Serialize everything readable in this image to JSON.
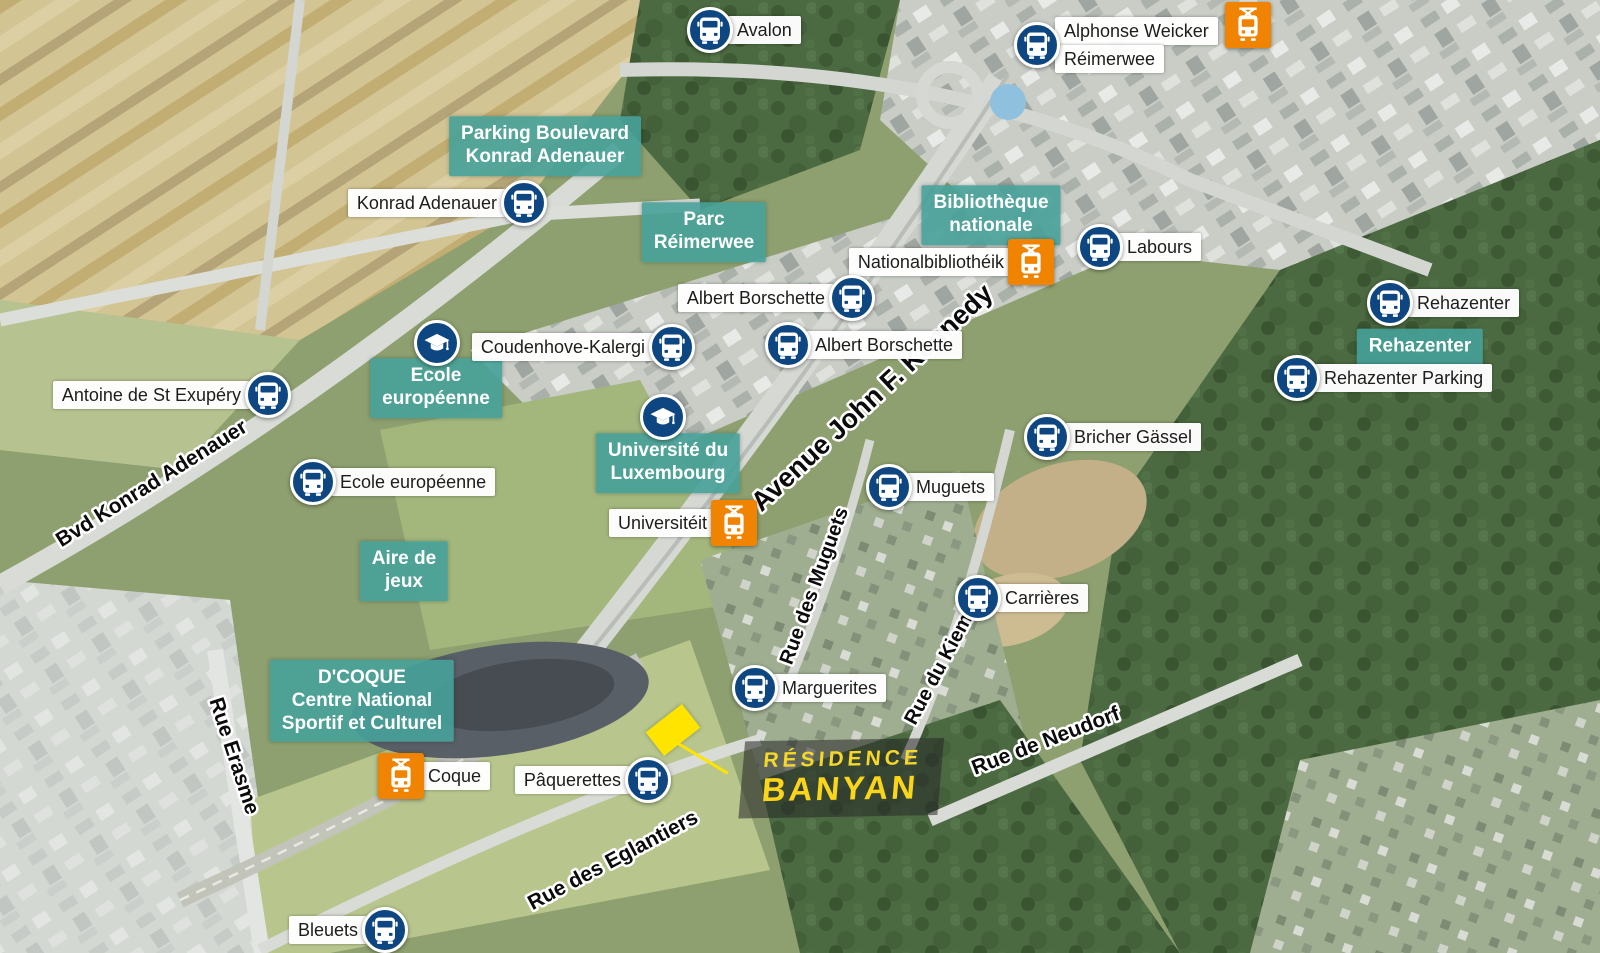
{
  "map": {
    "residence": {
      "line1": "RÉSIDENCE",
      "line2": "BANYAN"
    },
    "bus_stops": [
      {
        "lines": [
          "Avalon"
        ],
        "x": 710,
        "y": 30,
        "label_side": "right"
      },
      {
        "lines": [
          "Alphonse Weicker",
          "Réimerwee"
        ],
        "x": 1037,
        "y": 45,
        "label_side": "right"
      },
      {
        "lines": [
          "Konrad Adenauer"
        ],
        "x": 524,
        "y": 203,
        "label_side": "left"
      },
      {
        "lines": [
          "Labours"
        ],
        "x": 1100,
        "y": 247,
        "label_side": "right"
      },
      {
        "lines": [
          "Albert Borschette"
        ],
        "x": 852,
        "y": 298,
        "label_side": "left"
      },
      {
        "lines": [
          "Albert Borschette"
        ],
        "x": 788,
        "y": 345,
        "label_side": "right"
      },
      {
        "lines": [
          "Coudenhove-Kalergi"
        ],
        "x": 672,
        "y": 347,
        "label_side": "left"
      },
      {
        "lines": [
          "Rehazenter"
        ],
        "x": 1390,
        "y": 303,
        "label_side": "right"
      },
      {
        "lines": [
          "Rehazenter Parking"
        ],
        "x": 1297,
        "y": 378,
        "label_side": "right"
      },
      {
        "lines": [
          "Antoine de St Exupéry"
        ],
        "x": 268,
        "y": 395,
        "label_side": "left"
      },
      {
        "lines": [
          "Ecole européenne"
        ],
        "x": 313,
        "y": 482,
        "label_side": "right"
      },
      {
        "lines": [
          "Bricher Gässel"
        ],
        "x": 1047,
        "y": 437,
        "label_side": "right"
      },
      {
        "lines": [
          "Muguets"
        ],
        "x": 889,
        "y": 487,
        "label_side": "right"
      },
      {
        "lines": [
          "Carrières"
        ],
        "x": 978,
        "y": 598,
        "label_side": "right"
      },
      {
        "lines": [
          "Marguerites"
        ],
        "x": 755,
        "y": 688,
        "label_side": "right"
      },
      {
        "lines": [
          "Pâquerettes"
        ],
        "x": 648,
        "y": 780,
        "label_side": "left"
      },
      {
        "lines": [
          "Bleuets"
        ],
        "x": 385,
        "y": 930,
        "label_side": "left"
      }
    ],
    "tram_stops": [
      {
        "lines": [],
        "x": 1248,
        "y": 25,
        "label_side": "none"
      },
      {
        "lines": [
          "Nationalbibliothéik"
        ],
        "x": 1031,
        "y": 262,
        "label_side": "left"
      },
      {
        "lines": [
          "Universitéit"
        ],
        "x": 734,
        "y": 523,
        "label_side": "left"
      },
      {
        "lines": [
          "Coque"
        ],
        "x": 401,
        "y": 776,
        "label_side": "right"
      }
    ],
    "education_icons": [
      {
        "x": 437,
        "y": 343
      },
      {
        "x": 663,
        "y": 417
      }
    ],
    "poi_labels": [
      {
        "lines": [
          "Parking Boulevard",
          "Konrad Adenauer"
        ],
        "x": 545,
        "y": 146
      },
      {
        "lines": [
          "Parc",
          "Réimerwee"
        ],
        "x": 704,
        "y": 232
      },
      {
        "lines": [
          "Bibliothèque",
          "nationale"
        ],
        "x": 991,
        "y": 215
      },
      {
        "lines": [
          "Rehazenter"
        ],
        "x": 1420,
        "y": 347
      },
      {
        "lines": [
          "Ecole",
          "européenne"
        ],
        "x": 436,
        "y": 388
      },
      {
        "lines": [
          "Université du",
          "Luxembourg"
        ],
        "x": 668,
        "y": 463
      },
      {
        "lines": [
          "Aire de",
          "jeux"
        ],
        "x": 404,
        "y": 571
      },
      {
        "lines": [
          "D'COQUE",
          "Centre National",
          "Sportif et Culturel"
        ],
        "x": 362,
        "y": 701
      }
    ],
    "street_labels": [
      {
        "text": "Avenue John F. Kennedy",
        "x": 878,
        "y": 404,
        "rotation": -43,
        "size": 27
      },
      {
        "text": "Bvd Konrad Adenauer",
        "x": 155,
        "y": 489,
        "rotation": -32,
        "size": 21
      },
      {
        "text": "Rue Erasme",
        "x": 228,
        "y": 758,
        "rotation": 72,
        "size": 21
      },
      {
        "text": "Rue des Muguets",
        "x": 820,
        "y": 588,
        "rotation": -70,
        "size": 20
      },
      {
        "text": "Rue du Kiem",
        "x": 944,
        "y": 672,
        "rotation": -62,
        "size": 20
      },
      {
        "text": "Rue de Neudorf",
        "x": 1048,
        "y": 747,
        "rotation": -21,
        "size": 21
      },
      {
        "text": "Rue des Eglantiers",
        "x": 616,
        "y": 866,
        "rotation": -28,
        "size": 21
      }
    ],
    "colors": {
      "bus_blue": "#0d4680",
      "tram_orange": "#f08300",
      "poi_teal": "#46a199",
      "banyan_yellow": "#fbd51a",
      "marker_yellow": "#ffe400",
      "stop_label_bg": "#ffffff",
      "stop_label_text": "#1d1d1b"
    }
  }
}
